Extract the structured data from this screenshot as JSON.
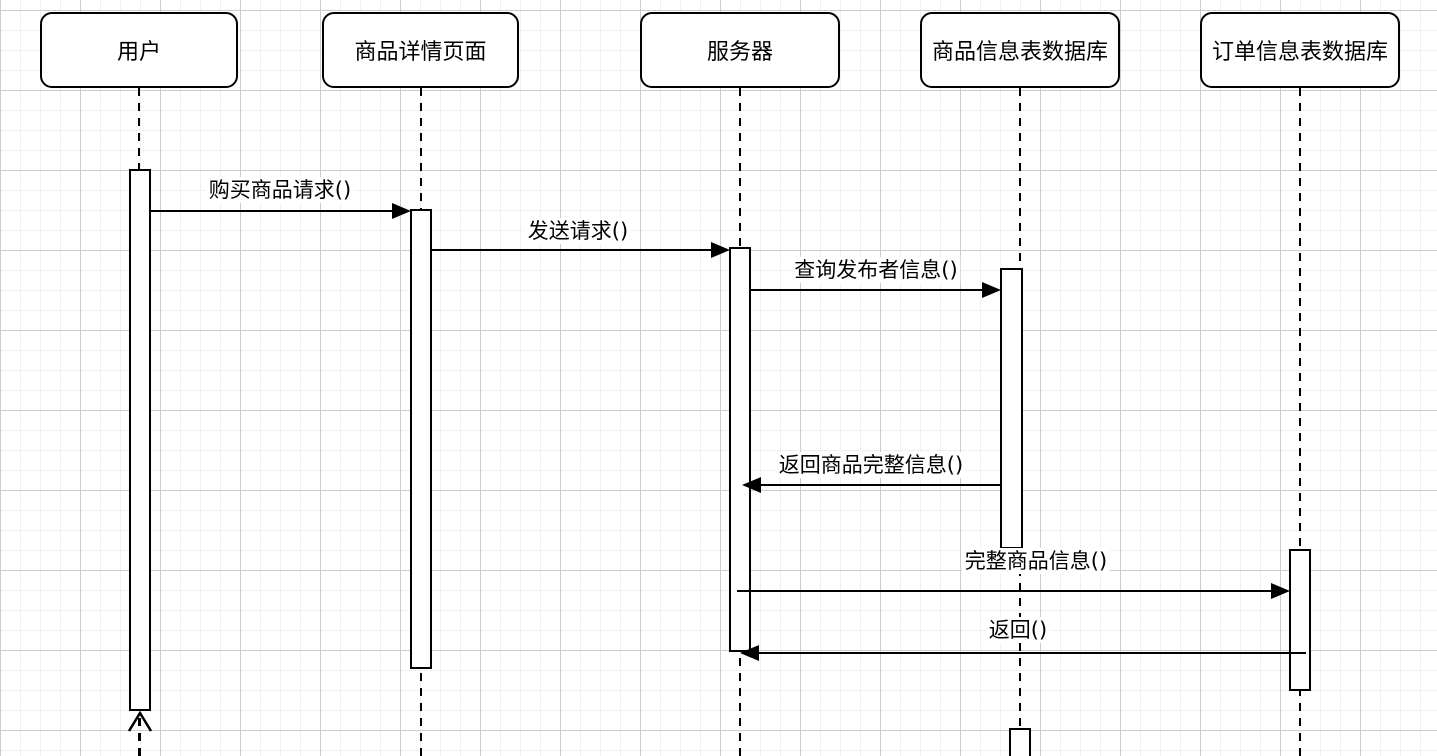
{
  "diagram": {
    "type": "uml-sequence-diagram",
    "language": "zh-CN",
    "colors": {
      "stroke": "#000000",
      "shape_fill": "#ffffff",
      "background": "#ffffff",
      "grid_minor": "#f0f0f0",
      "grid_major": "#cccccc"
    },
    "grid": {
      "minor_step_px": 20,
      "major_step_px": 80,
      "visible": true
    },
    "actors": [
      {
        "label": "用户"
      },
      {
        "label": "商品详情页面"
      },
      {
        "label": "服务器"
      },
      {
        "label": "商品信息表数据库"
      },
      {
        "label": "订单信息表数据库"
      }
    ],
    "messages": [
      {
        "label": "购买商品请求()",
        "from": "用户",
        "to": "商品详情页面",
        "line": "solid",
        "arrowhead": "filled",
        "direction": "right"
      },
      {
        "label": "发送请求()",
        "from": "商品详情页面",
        "to": "服务器",
        "line": "solid",
        "arrowhead": "filled",
        "direction": "right"
      },
      {
        "label": "查询发布者信息()",
        "from": "服务器",
        "to": "商品信息表数据库",
        "line": "solid",
        "arrowhead": "filled",
        "direction": "right"
      },
      {
        "label": "返回商品完整信息()",
        "from": "商品信息表数据库",
        "to": "服务器",
        "line": "solid",
        "arrowhead": "filled",
        "direction": "left"
      },
      {
        "label": "完整商品信息()",
        "from": "服务器",
        "to": "订单信息表数据库",
        "line": "solid",
        "arrowhead": "filled",
        "direction": "right"
      },
      {
        "label": "返回()",
        "from": "订单信息表数据库",
        "to": "服务器",
        "line": "solid",
        "arrowhead": "filled",
        "direction": "left"
      }
    ],
    "return_arrow": {
      "label": "",
      "at_actor": "用户",
      "line": "dashed",
      "arrowhead": "open",
      "direction": "up"
    }
  }
}
